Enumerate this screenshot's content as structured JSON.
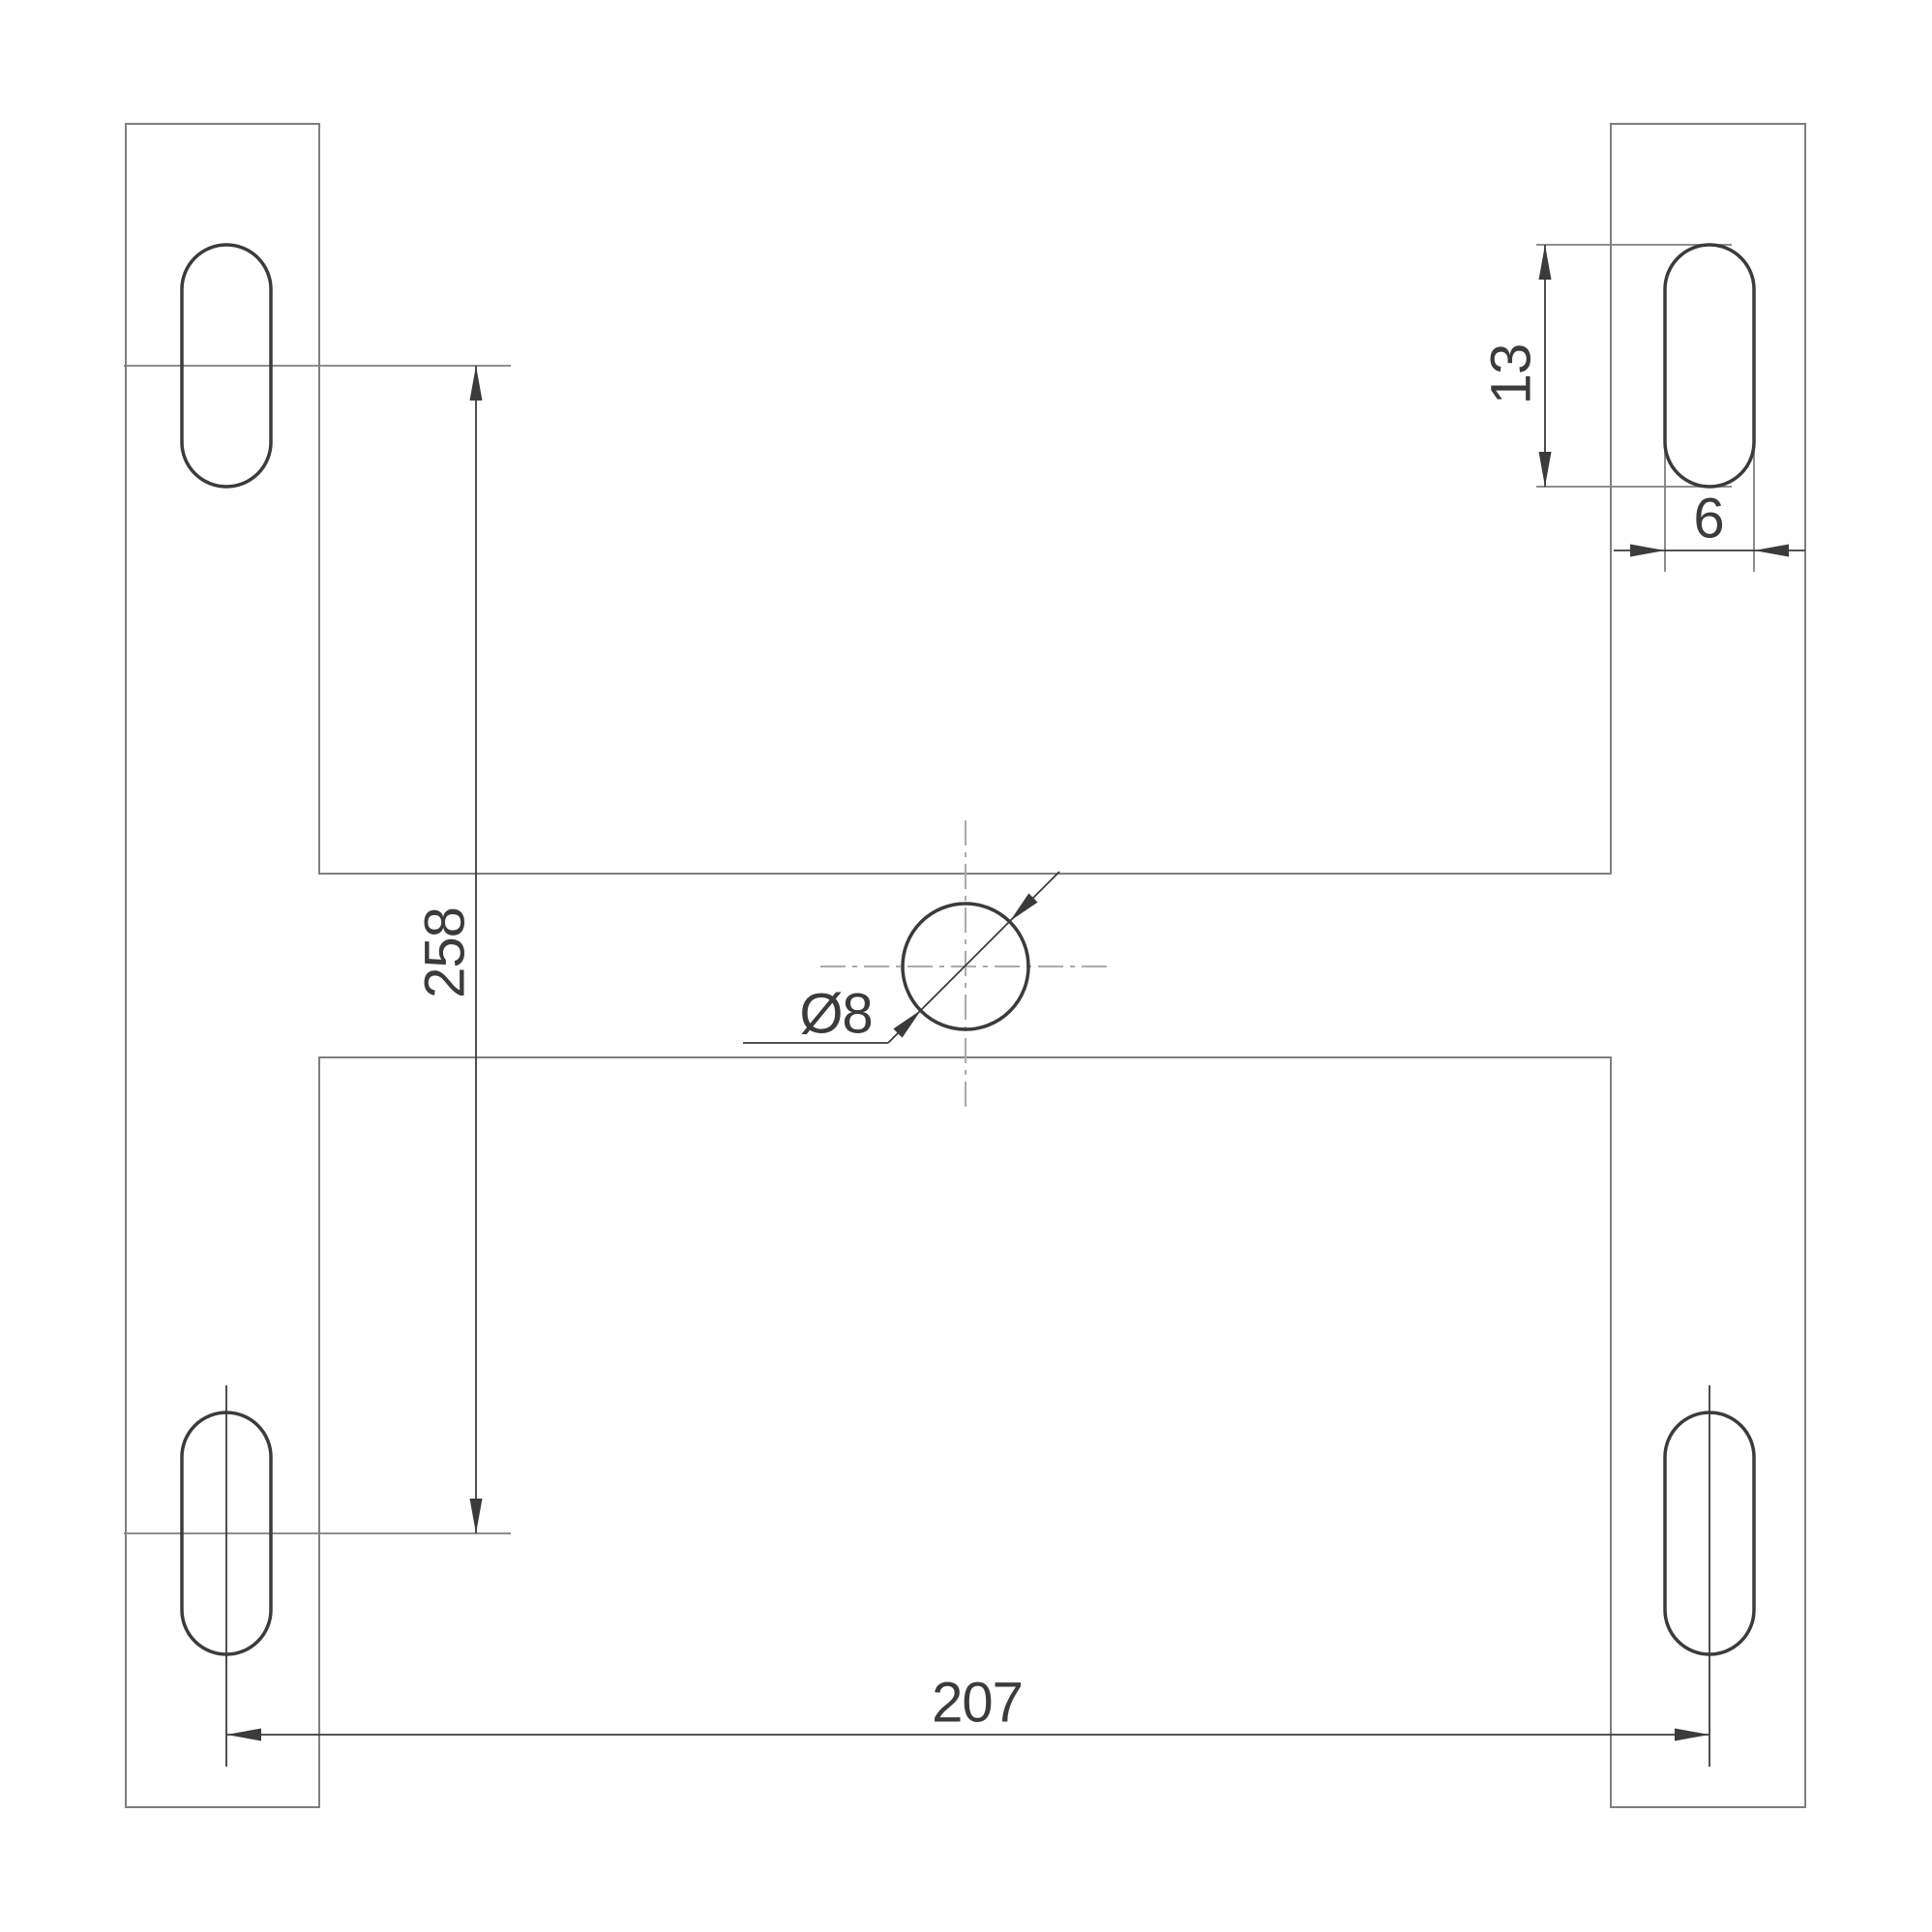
{
  "drawing": {
    "type": "technical-dimension-drawing",
    "description": "H-shaped mounting plate top view with four slotted holes and central round hole",
    "background": "#ffffff",
    "colors": {
      "part_outline": "#7f7f7f",
      "feature_dark": "#3b3b3b",
      "centerline": "#ababab"
    },
    "labels": {
      "vertical_spacing": "258",
      "horizontal_spacing": "207",
      "slot_length": "13",
      "slot_width": "6",
      "hole_diameter": "Ø8"
    },
    "features": {
      "slot_count": 4,
      "center_hole_count": 1
    }
  }
}
